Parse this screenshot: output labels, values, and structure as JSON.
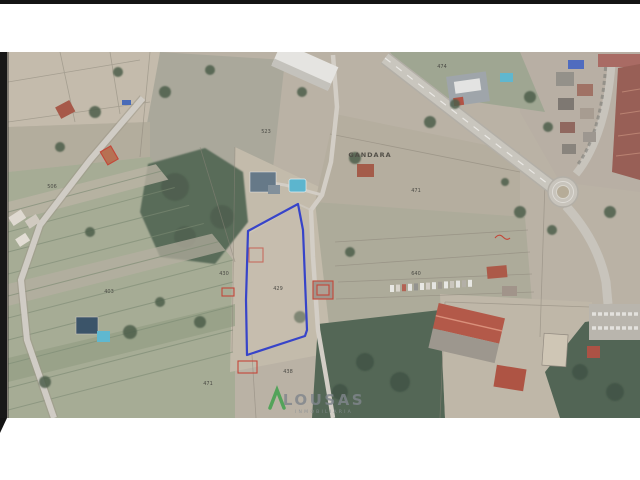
{
  "map": {
    "type": "aerial-cadastral-photo",
    "labels": {
      "gandara": "GANDARA",
      "p506": "506",
      "p523": "523",
      "p474": "474",
      "p471_right": "471",
      "p430": "430",
      "p429": "429",
      "p640": "640",
      "p403": "403",
      "p471_bottom": "471",
      "p438": "438"
    },
    "highlighted_parcel": {
      "number": "429",
      "outline_color": "#2a38c8"
    },
    "colors": {
      "parcel_highlight_blue": "#2a38c8",
      "cadastral_red": "#c23b2c",
      "logo_green": "#3da04a",
      "watermark_text": "#80868c",
      "watermark_tagline": "#8a9095"
    }
  },
  "watermark": {
    "brand": "LOUSAS",
    "tagline": "INMOBILIARIA"
  }
}
